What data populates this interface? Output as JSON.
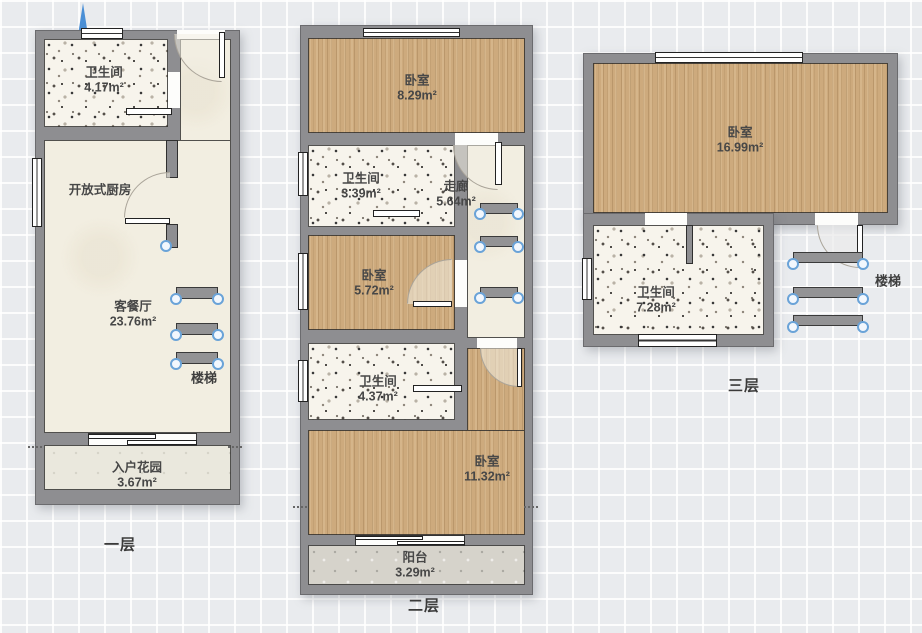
{
  "compass": {
    "south_label": "南"
  },
  "floors": [
    {
      "caption": "一层",
      "stairs_label": "楼梯",
      "rooms": [
        {
          "name": "卫生间",
          "area": "4.17m²"
        },
        {
          "name": "开放式厨房",
          "area": ""
        },
        {
          "name": "客餐厅",
          "area": "23.76m²"
        },
        {
          "name": "入户花园",
          "area": "3.67m²"
        }
      ]
    },
    {
      "caption": "二层",
      "rooms": [
        {
          "name": "卧室",
          "area": "8.29m²"
        },
        {
          "name": "卫生间",
          "area": "3.39m²"
        },
        {
          "name": "走廊",
          "area": "5.64m²"
        },
        {
          "name": "卧室",
          "area": "5.72m²"
        },
        {
          "name": "卫生间",
          "area": "4.37m²"
        },
        {
          "name": "卧室",
          "area": "11.32m²"
        },
        {
          "name": "阳台",
          "area": "3.29m²"
        }
      ]
    },
    {
      "caption": "三层",
      "stairs_label": "楼梯",
      "rooms": [
        {
          "name": "卧室",
          "area": "16.99m²"
        },
        {
          "name": "卫生间",
          "area": "7.28m²"
        }
      ]
    }
  ],
  "colors": {
    "wall": "#8e8e91",
    "wood_floor": "#cdaa7d",
    "handle_blue": "#6aa3d8",
    "cream_floor": "#f2eee1"
  }
}
